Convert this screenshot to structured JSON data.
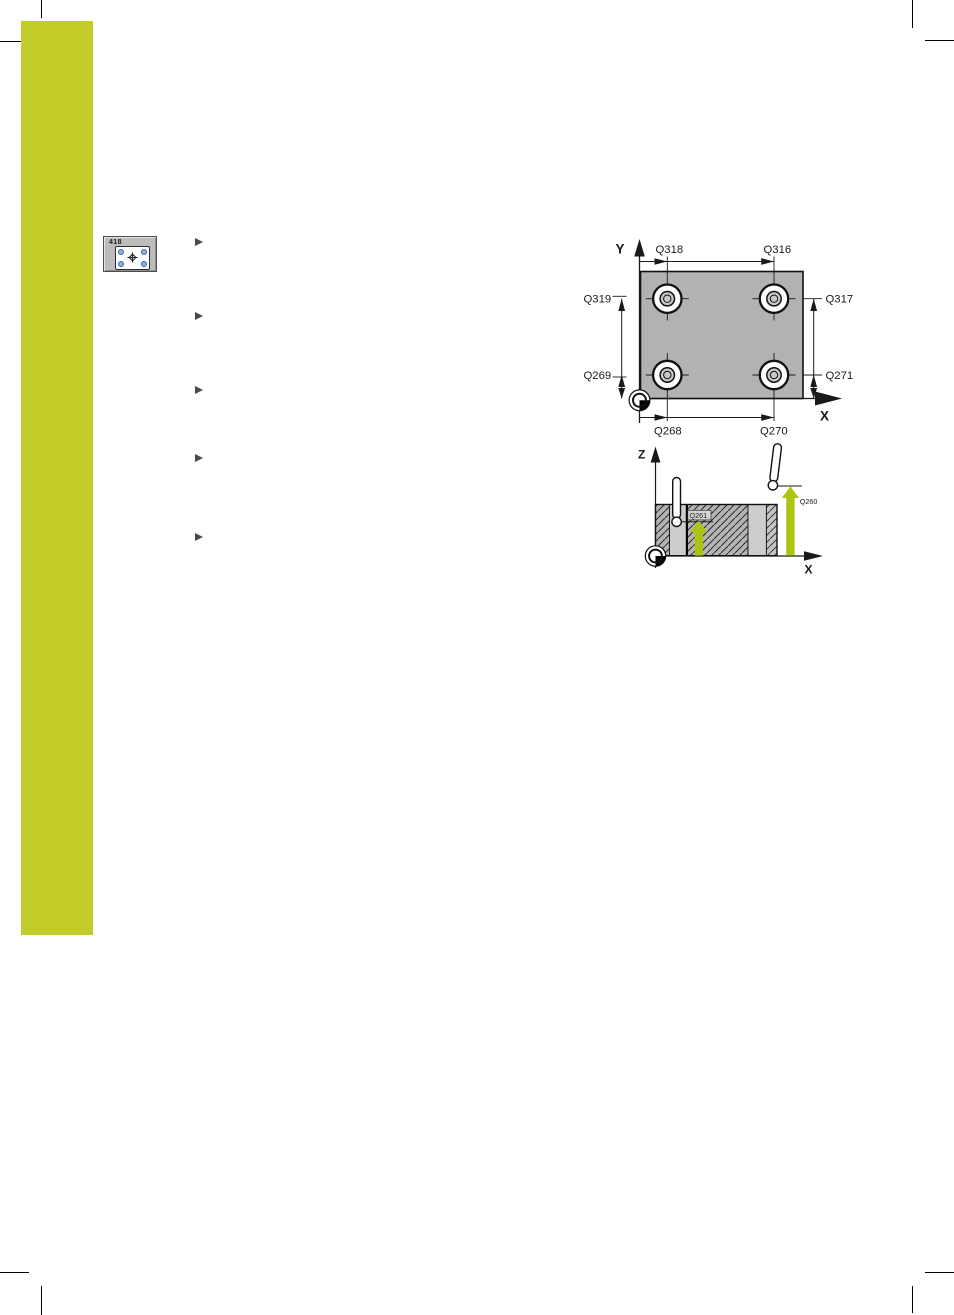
{
  "page": {
    "width": 954,
    "height": 1315,
    "background": "#ffffff"
  },
  "softkey": {
    "number": "418"
  },
  "bullets": {
    "count": 5
  },
  "top_view": {
    "axis_y": "Y",
    "axis_x": "X",
    "labels": {
      "q318": "Q318",
      "q316": "Q316",
      "q319": "Q319",
      "q317": "Q317",
      "q269": "Q269",
      "q271": "Q271",
      "q268": "Q268",
      "q270": "Q270"
    }
  },
  "side_view": {
    "axis_z": "Z",
    "axis_x": "X",
    "labels": {
      "q261": "Q261",
      "q260": "Q260"
    }
  },
  "colors": {
    "accent_green": "#c3cd29",
    "arrow_green": "#adc512",
    "part_gray": "#b2b2b2",
    "hole_gray": "#c8c8c8",
    "line_black": "#1a1a1a"
  }
}
